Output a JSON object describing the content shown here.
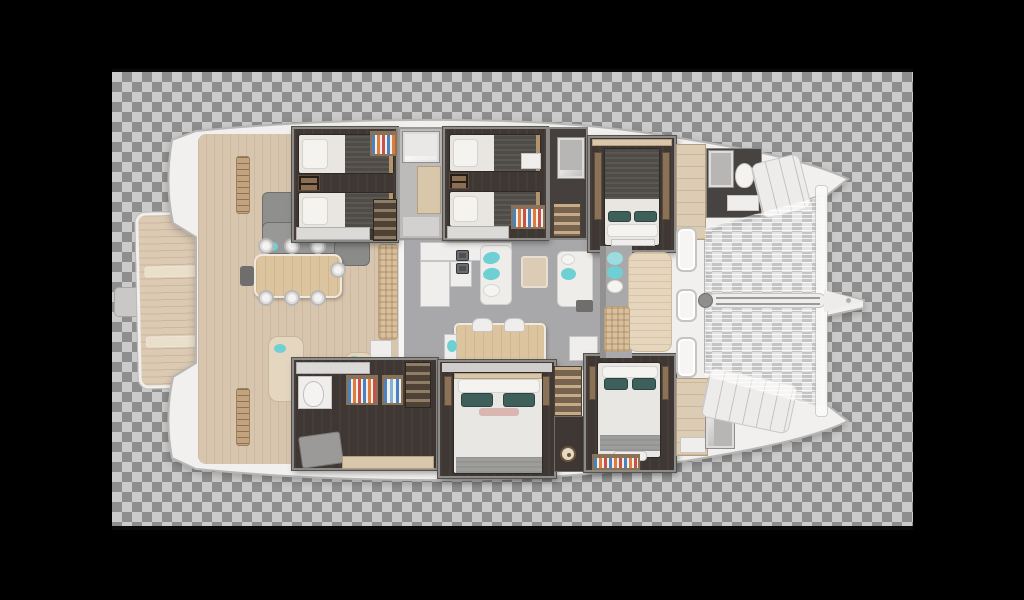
{
  "scene": {
    "type": "yacht-floor-plan",
    "subject": "Sailing catamaran top-down interior layout render",
    "orientation": "bow pointing right",
    "background": "transparency checkerboard inside black letterbox"
  },
  "canvas": {
    "width": 1024,
    "height": 600,
    "outer_background": "#000000"
  },
  "checkerboard": {
    "x": 112,
    "y": 72,
    "width": 801,
    "height": 454,
    "square_px": 10,
    "light": "#cbcbcb",
    "dark": "#8e8e8e"
  },
  "frame_lines": {
    "color": "#0a0a0a",
    "top": {
      "x": 112,
      "y": 69,
      "w": 801,
      "h": 3
    },
    "bottom": {
      "x": 112,
      "y": 526,
      "w": 801,
      "h": 4
    }
  },
  "palette": {
    "hull_white": "#f1f0ee",
    "hull_outline": "#b7b6b4",
    "teak_deck": "#d8c5ad",
    "swim_platform": "#dccab3",
    "salon_floor": "#a8a7a9",
    "cabin_floor": "#3e3733",
    "wood_trim": "#b3946f",
    "duvet_dark": "#4f4b47",
    "linen_white": "#eceae6",
    "blanket_gray": "#9d9d9b",
    "pillow_teal": "#6fd0d4",
    "pillow_dark_teal": "#3f5f5b",
    "pillow_pink": "#d9b6b0",
    "wall_gray": "#bcbbb9",
    "stair_wood": "#8f7d65"
  },
  "rooms": [
    {
      "name": "Aft twin guest cabin, port hull"
    },
    {
      "name": "Midship twin guest cabin, port hull"
    },
    {
      "name": "Forward double cabin, port hull"
    },
    {
      "name": "Utility and head compartment, starboard hull aft"
    },
    {
      "name": "Midship double cabin, starboard hull"
    },
    {
      "name": "Forward double cabin, starboard hull"
    },
    {
      "name": "Main salon with L-shaped galley and dinette"
    },
    {
      "name": "Aft cockpit with teak deck and dining table"
    },
    {
      "name": "Foredeck with sun pad and deck hatches"
    },
    {
      "name": "Bow trampoline net with bowsprit"
    },
    {
      "name": "Aft swim platform"
    }
  ],
  "vessel": {
    "hulls": 2,
    "cabins_twin": 2,
    "cabins_double": 3,
    "bow_berths": 2,
    "salon_features": [
      "L-shaped galley",
      "two lounge sofas",
      "area rug",
      "dinette table with two chairs",
      "TV cabinet"
    ],
    "cockpit_features": [
      "dining table",
      "seven seats",
      "gray lounge",
      "curved bench sofa",
      "wet bar"
    ],
    "foredeck_features": [
      "sun pad",
      "wicker mat",
      "three deck hatches",
      "windlass",
      "trampoline",
      "bowsprit"
    ]
  }
}
